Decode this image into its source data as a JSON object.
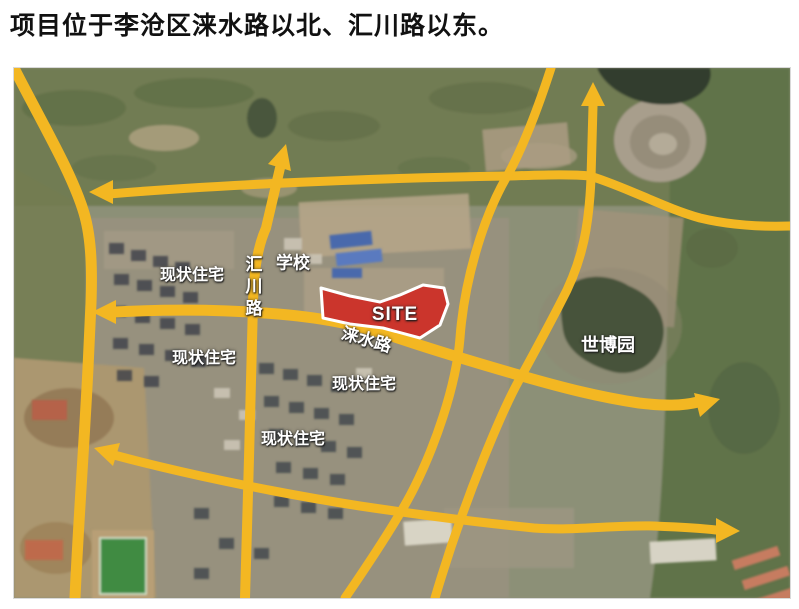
{
  "title": "项目位于李沧区涞水路以北、汇川路以东。",
  "map": {
    "site_label": "SITE",
    "labels": {
      "school": "学校",
      "huichuan_road": "汇川路",
      "laishui_road": "涞水路",
      "expo_park": "世博园",
      "residential_nw": "现状住宅",
      "residential_w": "现状住宅",
      "residential_center": "现状住宅",
      "residential_south": "现状住宅"
    },
    "colors": {
      "road": "#F3B722",
      "site_fill": "#CB352C",
      "site_border": "#FFFFFF"
    }
  }
}
